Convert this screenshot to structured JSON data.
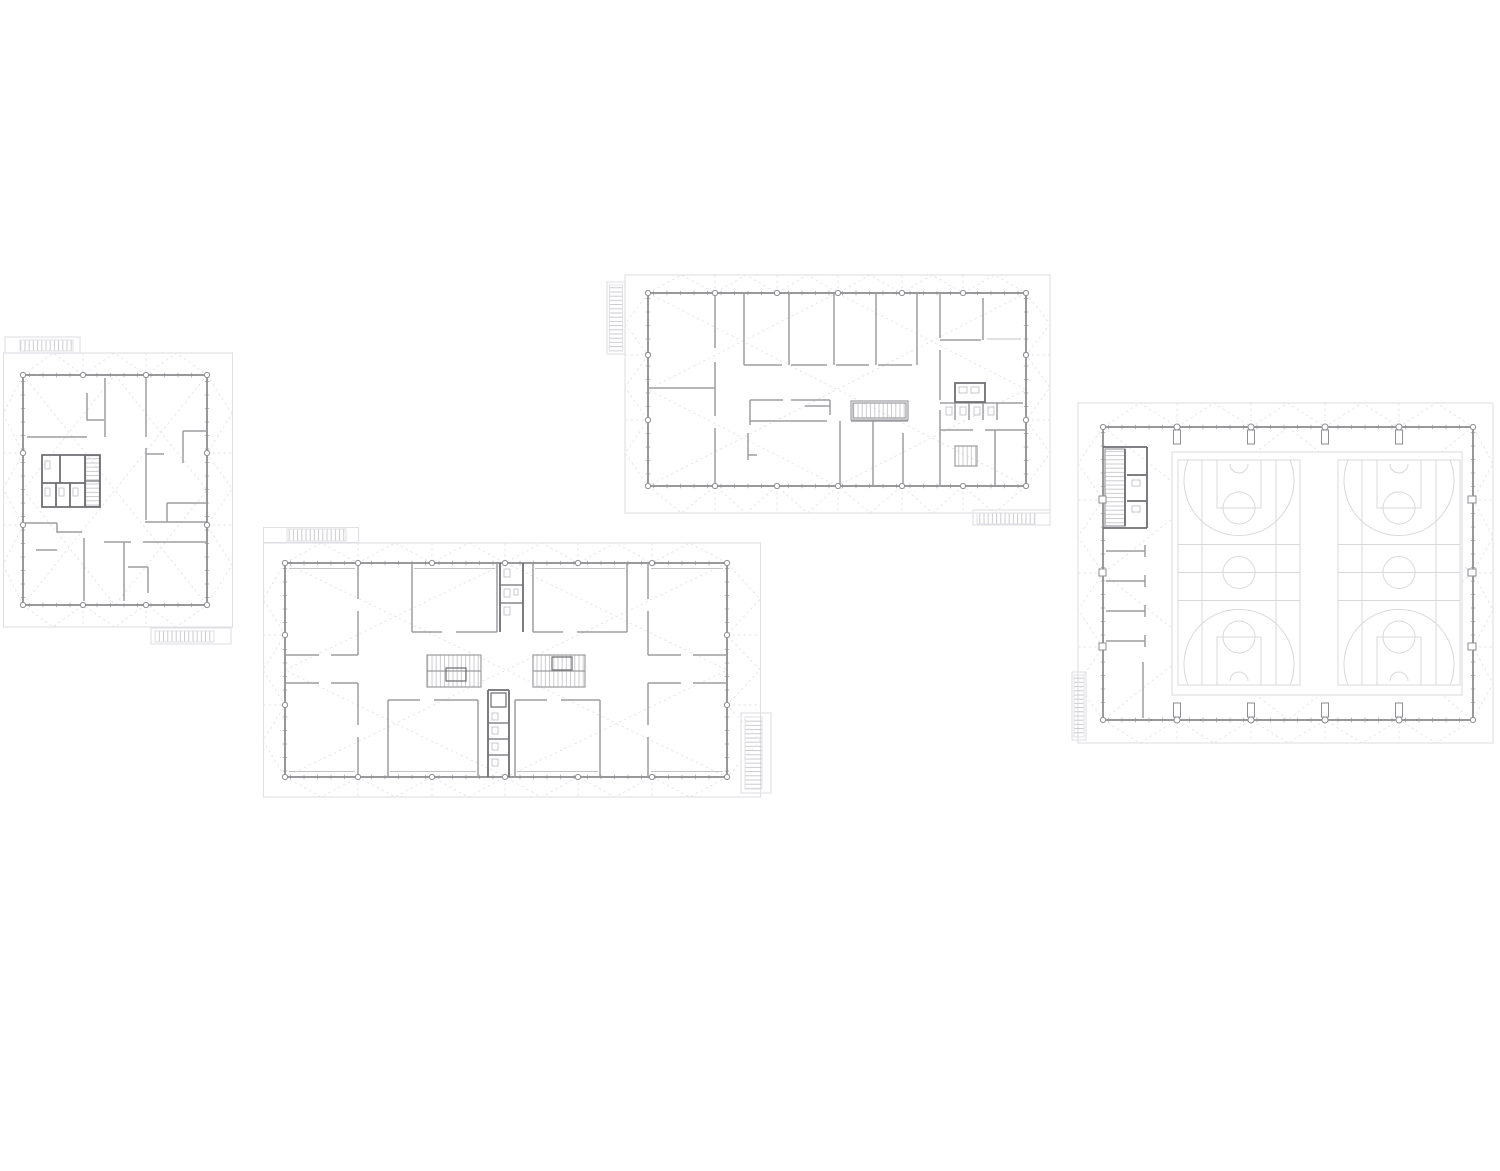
{
  "document": {
    "type": "architectural-floor-plan-sheet",
    "plan_count": 4,
    "visible_text": "none"
  },
  "colors": {
    "background": "#ffffff",
    "roof_outline": "#e0e0e4",
    "fold_line": "#e4e4e8",
    "wall": "#8e8e92",
    "partition": "#9d9da1",
    "core_wall": "#6f6f73",
    "hatch": "#c6c6ca",
    "tick": "#bababe",
    "court_line": "#d9d9dd",
    "fixture": "#c3c3c7",
    "column_fill": "#ffffff"
  },
  "plans": [
    {
      "id": "plan-a",
      "name": "small-floor-plan",
      "position": "top-left",
      "features": {
        "stair_cores": 1,
        "toilet_core": true,
        "exterior_stairs": 2
      }
    },
    {
      "id": "plan-b",
      "name": "wide-floor-plan",
      "position": "top-center",
      "features": {
        "classroom_partitions": 5,
        "stair_cores": 2,
        "toilet_block": true,
        "exterior_stairs": 2
      }
    },
    {
      "id": "plan-c",
      "name": "large-floor-plan",
      "position": "bottom-center",
      "features": {
        "perimeter_rooms": 8,
        "stair_cores": 2,
        "toilet_cores": 2,
        "exterior_stairs": 2
      }
    },
    {
      "id": "plan-d",
      "name": "sports-hall-plan",
      "position": "right",
      "features": {
        "basketball_courts": 2,
        "stair_core": 1,
        "changing_rooms": 4,
        "exterior_stairs": 1
      }
    }
  ]
}
